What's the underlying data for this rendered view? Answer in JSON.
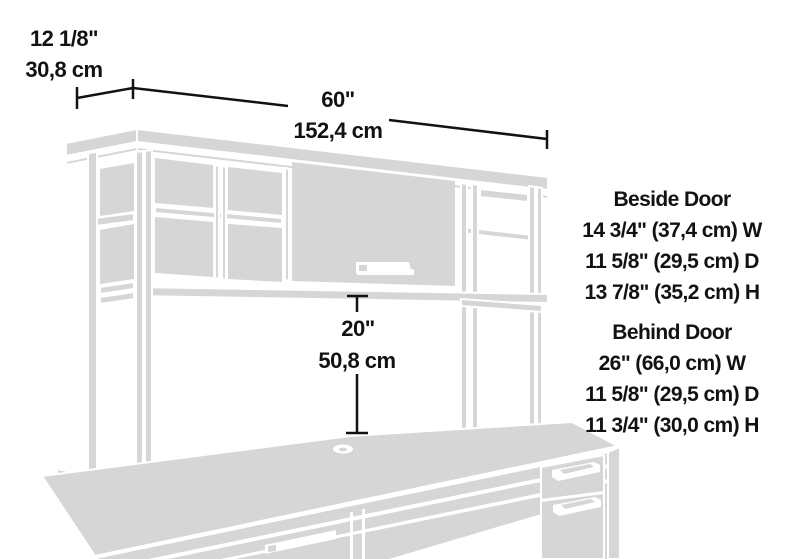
{
  "diagram_title": "Desk with hutch dimension diagram",
  "dimensions": {
    "depth": {
      "inches": "12 1/8\"",
      "metric": "30,8 cm"
    },
    "width": {
      "inches": "60\"",
      "metric": "152,4 cm"
    },
    "clearance": {
      "inches": "20\"",
      "metric": "50,8 cm"
    }
  },
  "compartments": [
    {
      "title": "Beside Door",
      "lines": [
        "14 3/4\" (37,4 cm) W",
        "11 5/8\" (29,5 cm) D",
        "13 7/8\" (35,2 cm) H"
      ]
    },
    {
      "title": "Behind Door",
      "lines": [
        "26\" (66,0 cm) W",
        "11 5/8\" (29,5 cm) D",
        "11 3/4\" (30,0 cm) H"
      ]
    }
  ],
  "colors": {
    "background": "#ffffff",
    "line_art_gray": "#d6d6d6",
    "text": "#121212",
    "dimension_line": "#121212"
  }
}
